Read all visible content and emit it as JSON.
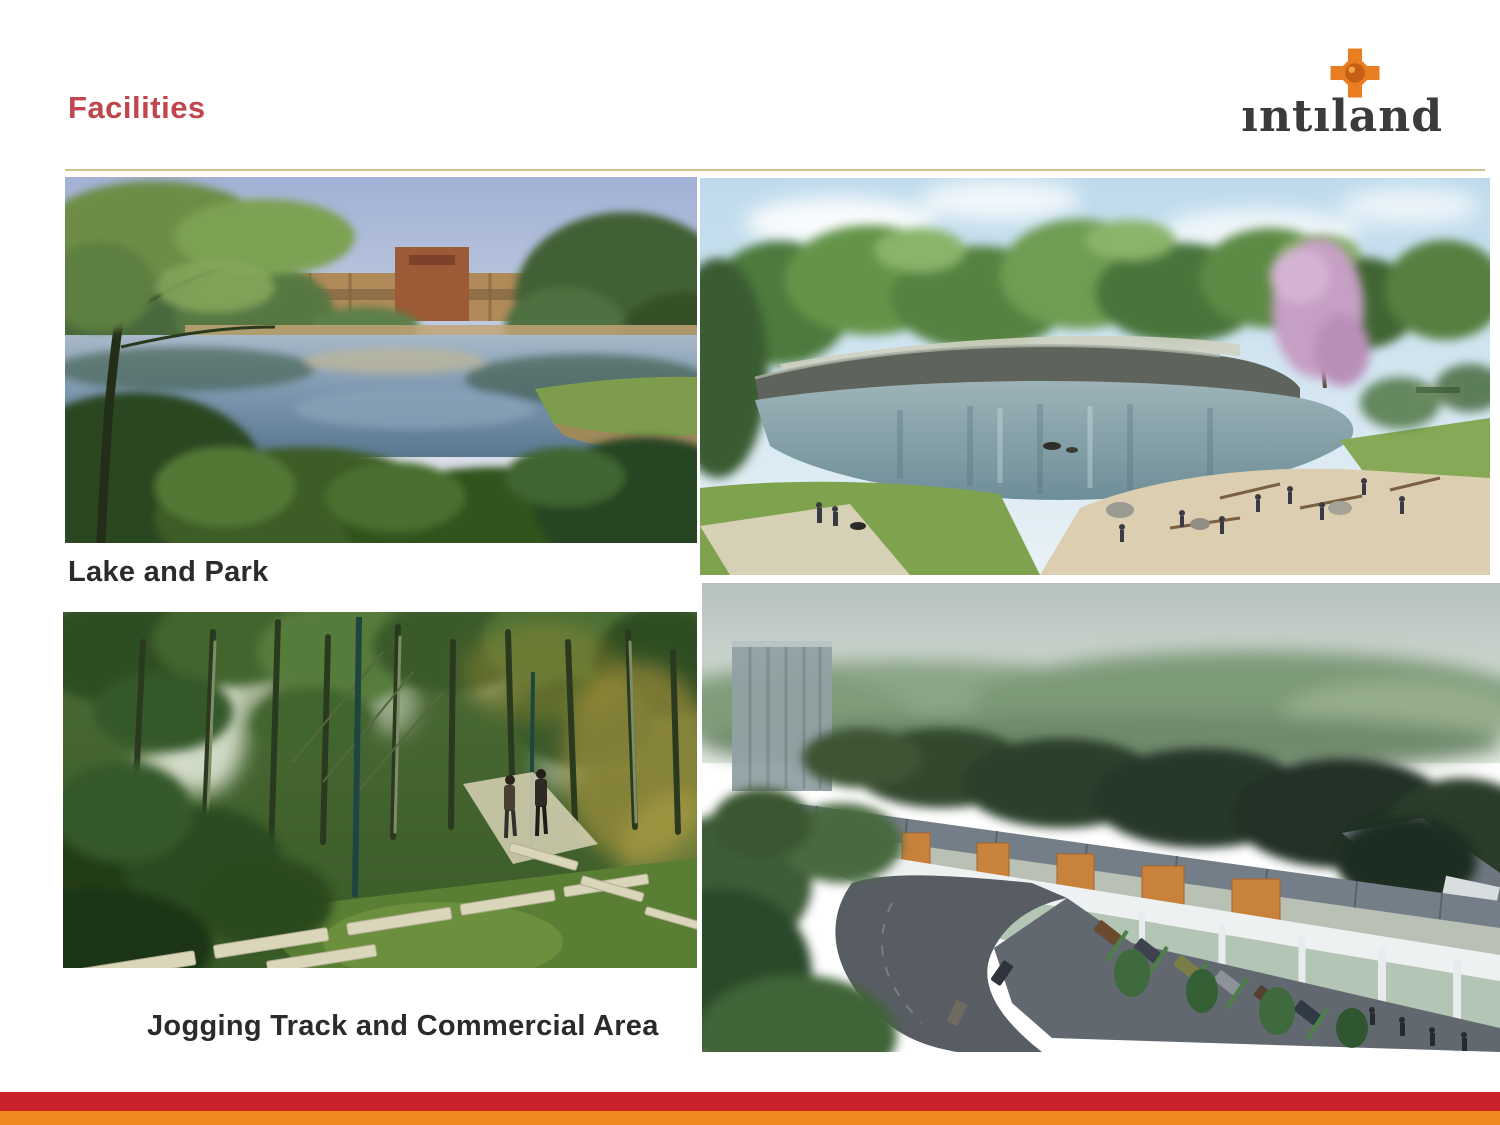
{
  "slide": {
    "title": "Facilities",
    "logo_text": "ıntıland",
    "caption_lake": "Lake and Park",
    "caption_jogging": "Jogging Track and Commercial Area"
  },
  "images": {
    "lake_park_photo": "lake and park with resort building",
    "lake_render": "lake rendering with beach, rock wall and pink blossom tree",
    "jogging_track_photo": "jogging track with stepping stones through forest",
    "commercial_area_render": "aerial rendering of shophouse commercial area with road and parking"
  },
  "colors": {
    "title": "#c0454d",
    "divider": "#d2bf8e",
    "caption": "#2b2b2b",
    "logo_text": "#3b3b3b",
    "logo_star": "#e87d22",
    "logo_star_core": "#c65f14",
    "bar_red": "#c9222b",
    "bar_orange": "#f0891f"
  }
}
